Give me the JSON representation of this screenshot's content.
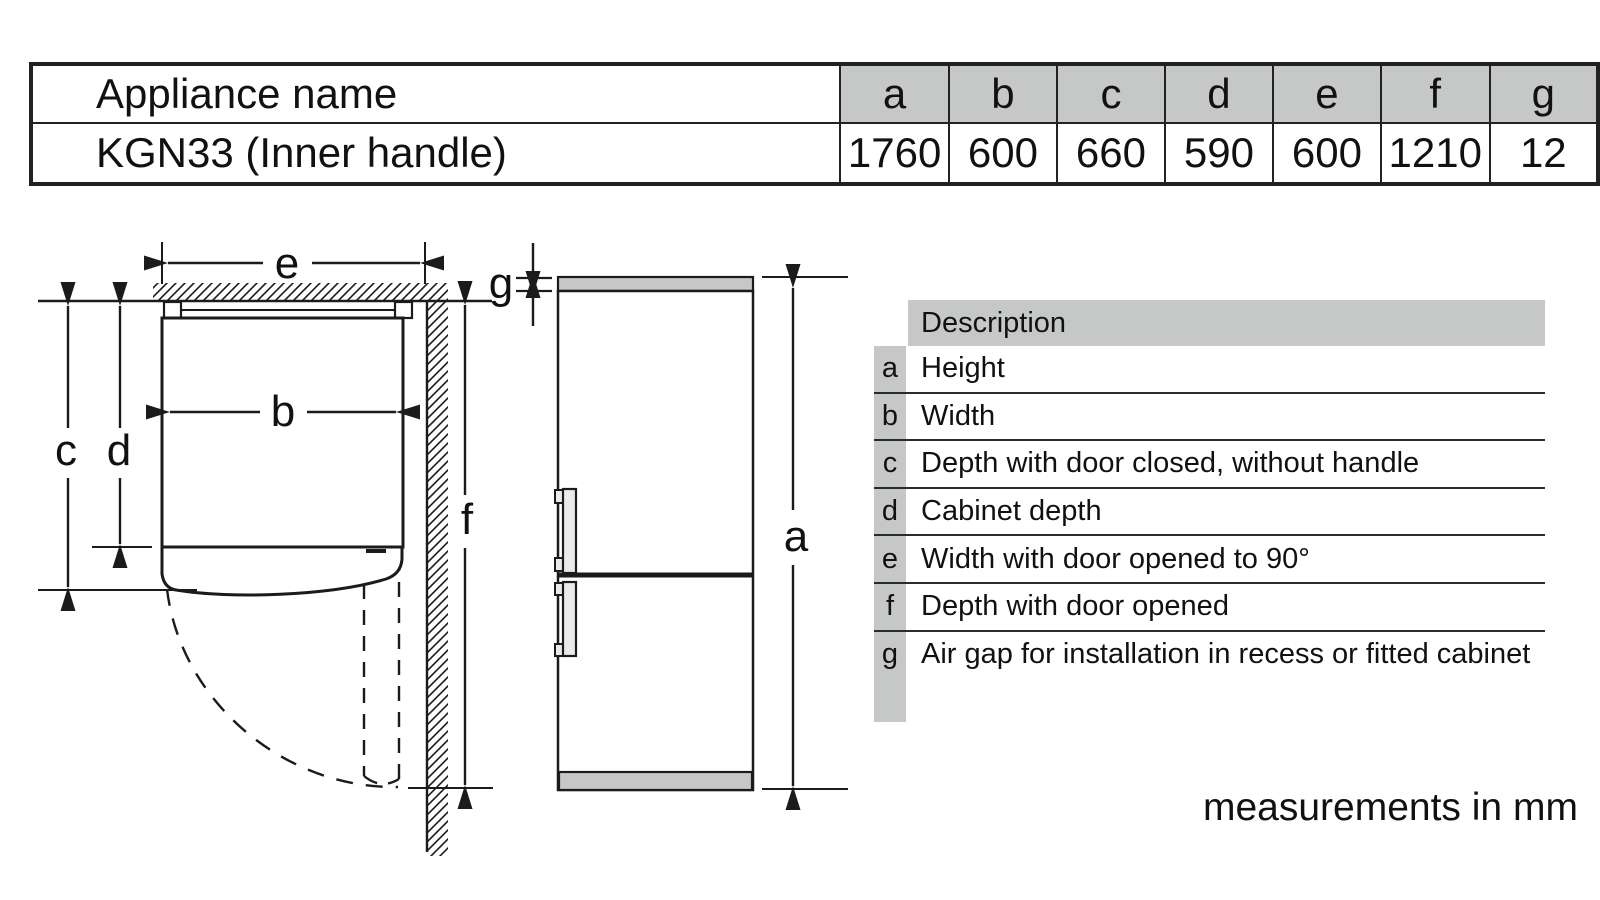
{
  "top_table": {
    "header_label": "Appliance name",
    "columns": [
      "a",
      "b",
      "c",
      "d",
      "e",
      "f",
      "g"
    ],
    "rows": [
      {
        "label": "KGN33 (Inner handle)",
        "values": [
          "1760",
          "600",
          "660",
          "590",
          "600",
          "1210",
          "12"
        ]
      }
    ]
  },
  "description_table": {
    "header": "Description",
    "rows": [
      {
        "key": "a",
        "text": "Height"
      },
      {
        "key": "b",
        "text": "Width"
      },
      {
        "key": "c",
        "text": "Depth with door closed, without handle"
      },
      {
        "key": "d",
        "text": "Cabinet depth"
      },
      {
        "key": "e",
        "text": "Width with door opened to 90°"
      },
      {
        "key": "f",
        "text": "Depth with door opened"
      },
      {
        "key": "g",
        "text": "Air gap for installation in recess or fitted cabinet"
      }
    ]
  },
  "diagrams": {
    "top_view": {
      "labels": {
        "b": "b",
        "c": "c",
        "d": "d",
        "e": "e",
        "f": "f"
      }
    },
    "front_view": {
      "labels": {
        "a": "a",
        "g": "g"
      }
    }
  },
  "footnote": "measurements in mm",
  "colors": {
    "fill_gray": "#c6c8c7",
    "line": "#1b1b1b"
  }
}
